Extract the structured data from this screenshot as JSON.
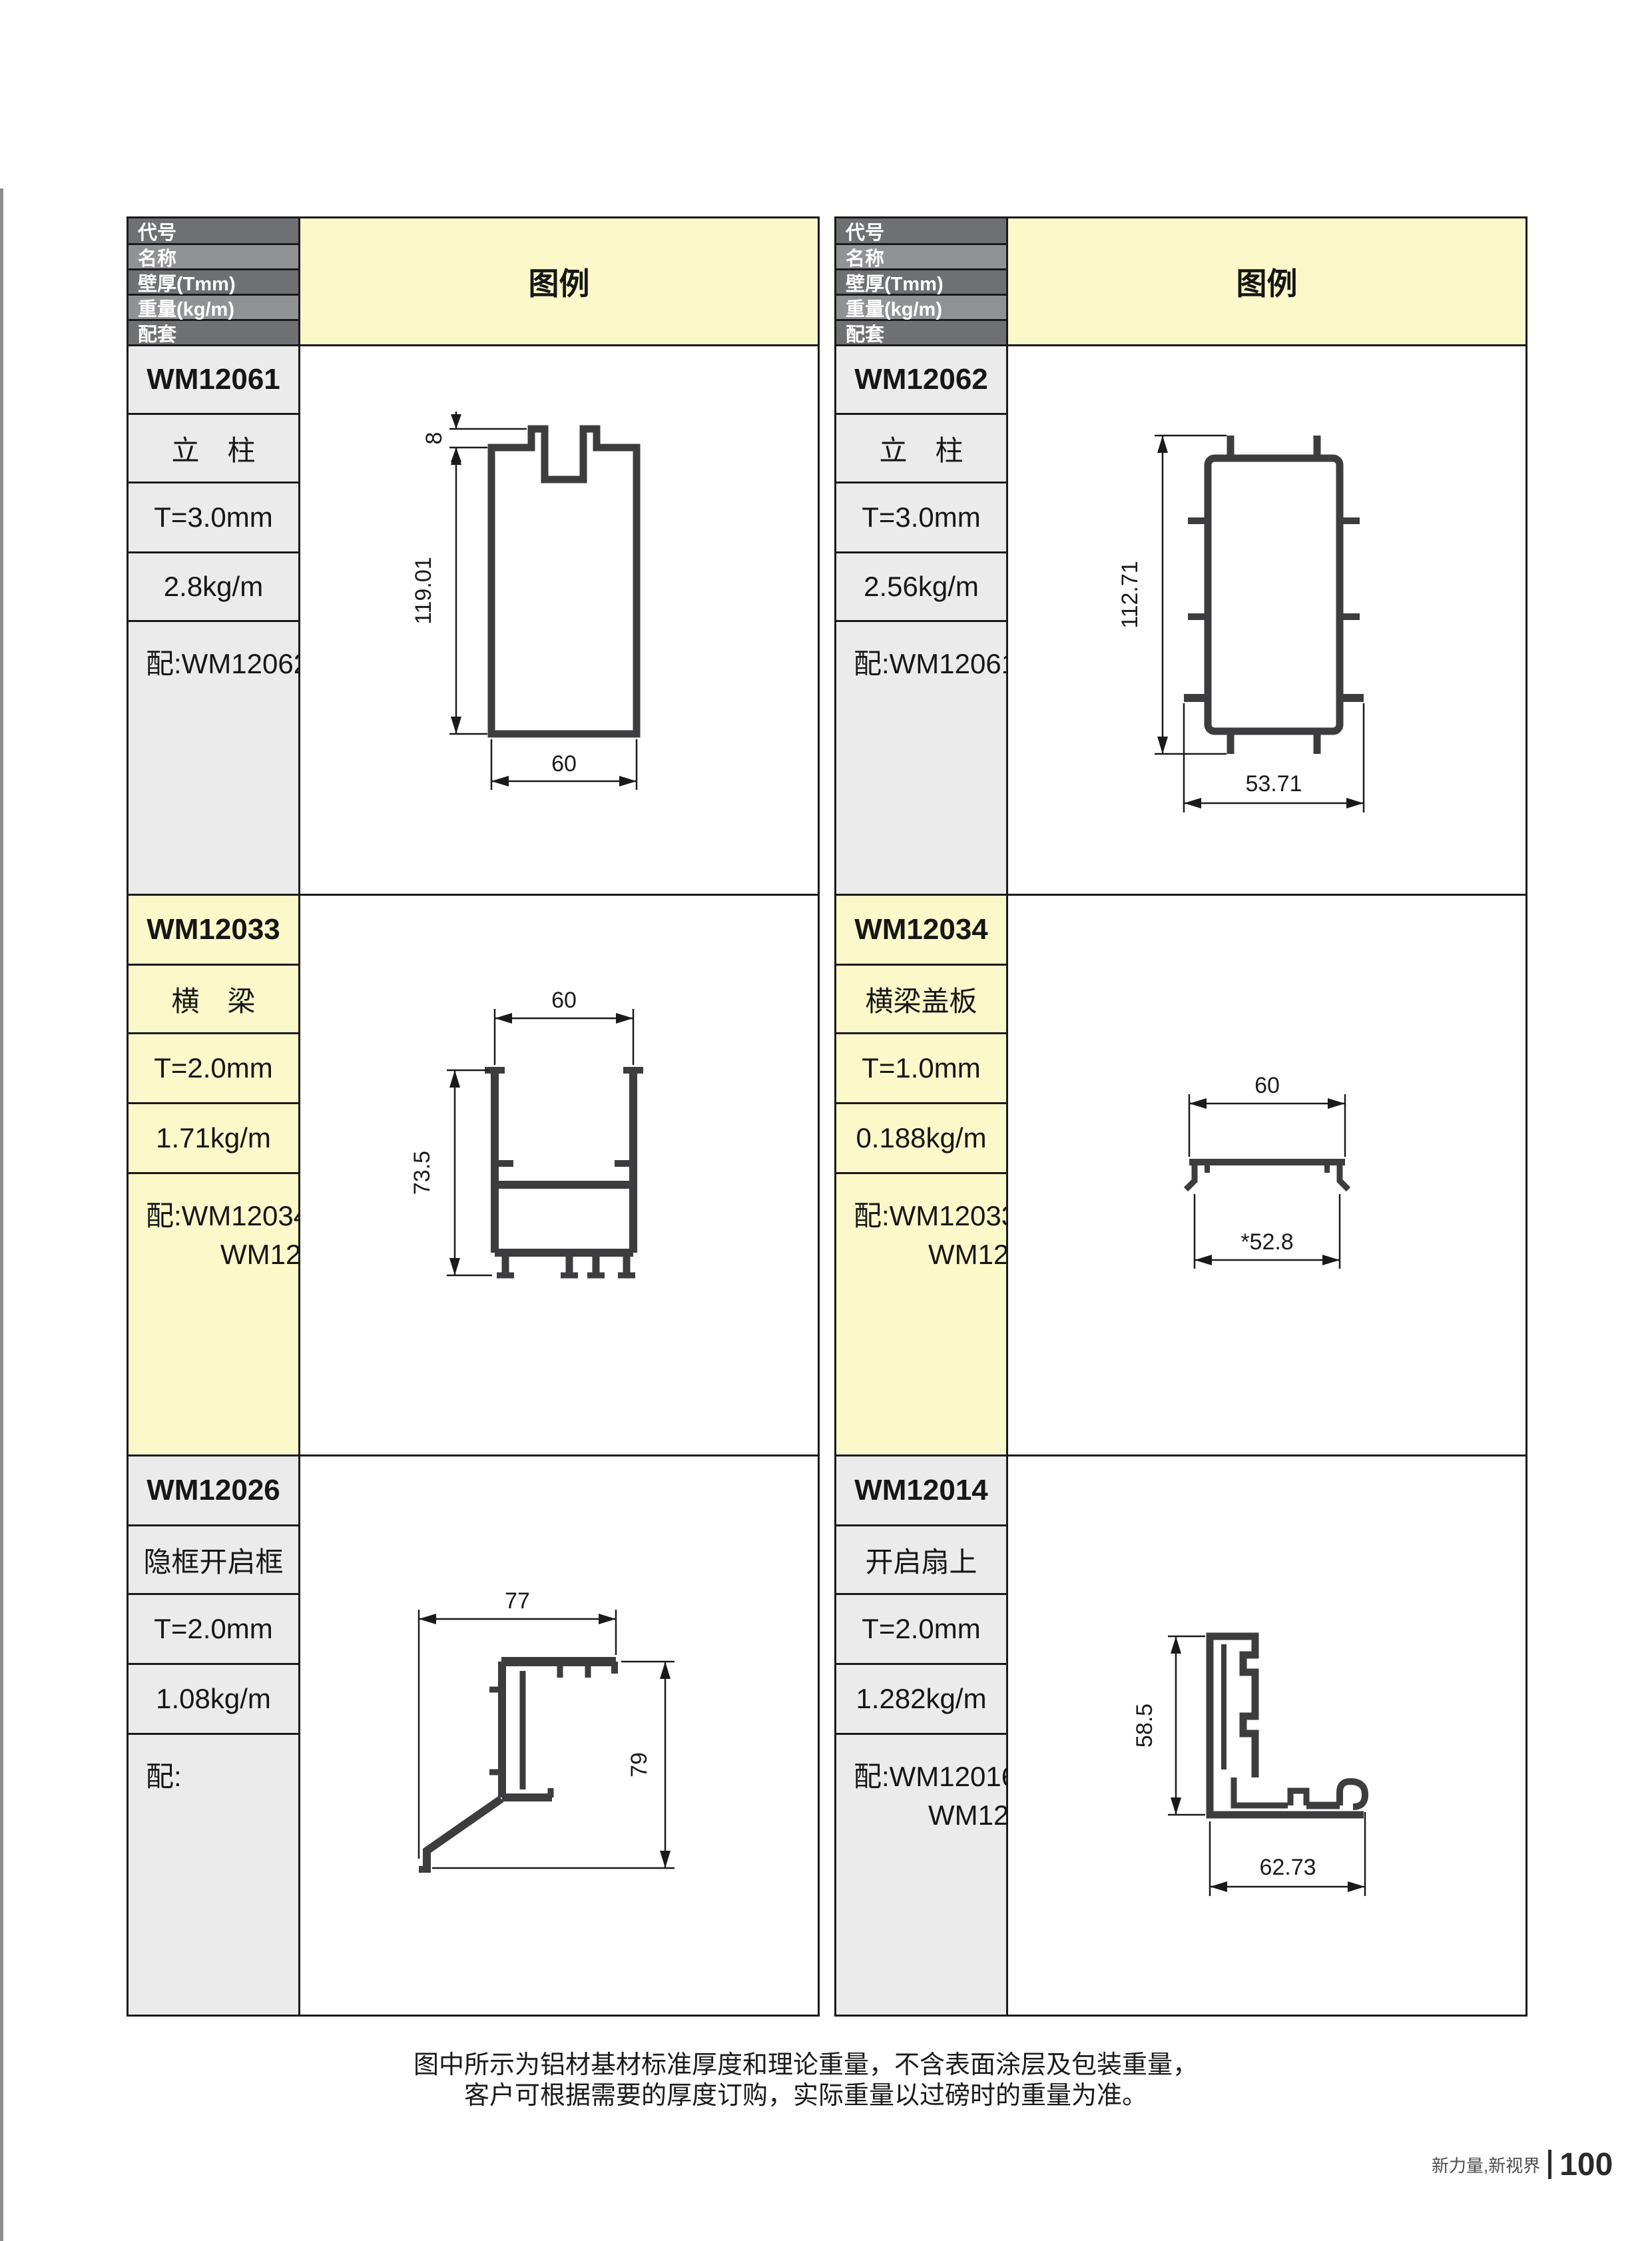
{
  "header": {
    "row_labels": [
      "代号",
      "名称",
      "壁厚(Tmm)",
      "重量(kg/m)",
      "配套"
    ],
    "diagram_label": "图例"
  },
  "profiles": [
    {
      "code": "WM12061",
      "name": "立　柱",
      "thickness": "T=3.0mm",
      "weight": "2.8kg/m",
      "mate_line1": "配:WM12062",
      "mate_line2": "",
      "dims": {
        "top": "8",
        "height": "119.01",
        "width": "60"
      }
    },
    {
      "code": "WM12062",
      "name": "立　柱",
      "thickness": "T=3.0mm",
      "weight": "2.56kg/m",
      "mate_line1": "配:WM12061",
      "mate_line2": "",
      "dims": {
        "height": "112.71",
        "width": "53.71"
      }
    },
    {
      "code": "WM12033",
      "name": "横　梁",
      "thickness": "T=2.0mm",
      "weight": "1.71kg/m",
      "mate_line1": "配:WM12034",
      "mate_line2": "WM12037",
      "dims": {
        "width": "60",
        "height": "73.5"
      }
    },
    {
      "code": "WM12034",
      "name": "横梁盖板",
      "thickness": "T=1.0mm",
      "weight": "0.188kg/m",
      "mate_line1": "配:WM12033",
      "mate_line2": "WM12053",
      "dims": {
        "width": "60",
        "inner_width": "*52.8"
      }
    },
    {
      "code": "WM12026",
      "name": "隐框开启框",
      "thickness": "T=2.0mm",
      "weight": "1.08kg/m",
      "mate_line1": "配:",
      "mate_line2": "",
      "dims": {
        "width": "77",
        "height": "79"
      }
    },
    {
      "code": "WM12014",
      "name": "开启扇上",
      "thickness": "T=2.0mm",
      "weight": "1.282kg/m",
      "mate_line1": "配:WM12016",
      "mate_line2": "WM12019",
      "dims": {
        "height": "58.5",
        "width": "62.73"
      }
    }
  ],
  "footer": {
    "note_line1": "图中所示为铝材基材标准厚度和理论重量，不含表面涂层及包装重量，",
    "note_line2": "客户可根据需要的厚度订购，实际重量以过磅时的重量为准。",
    "brand": "新力量,新视界",
    "page_number": "100"
  },
  "colors": {
    "legend_yellow": "#fbf8c9",
    "cell_gray": "#ebebec",
    "header_dark": "#6f7073",
    "header_light": "#919295",
    "grid_line": "#1a1a1a",
    "profile_stroke": "#3d3d3f"
  }
}
